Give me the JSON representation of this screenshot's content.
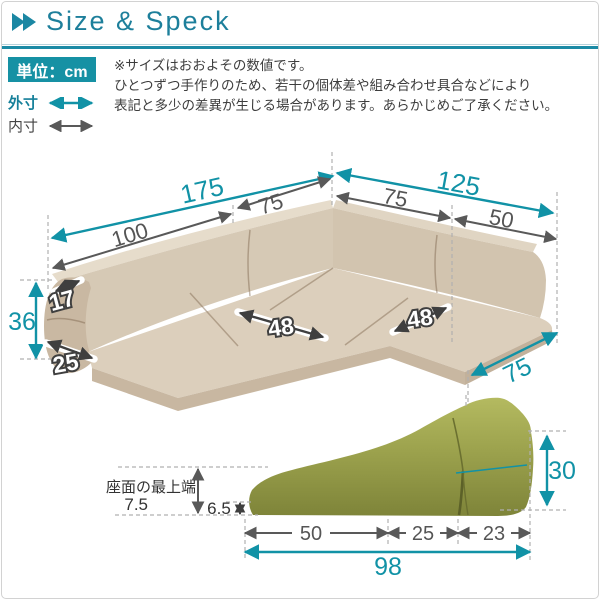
{
  "header": {
    "title": "Size & Speck"
  },
  "legend": {
    "unit": "単位：cm",
    "outer": "外寸",
    "inner": "内寸"
  },
  "notes": [
    "※サイズはおおよその数値です。",
    "ひとつずつ手作りのため、若干の個体差や組み合わせ具合などにより",
    "表記と多少の差異が生じる場合があります。あらかじめご了承ください。"
  ],
  "sofa": {
    "total_back_left": "175",
    "back_left": "100",
    "corner_left": "75",
    "total_back_right": "125",
    "corner_right": "75",
    "back_right": "50",
    "back_height": "36",
    "back_top_depth": "17",
    "back_bottom_depth": "25",
    "seat_width_left": "48",
    "seat_width_right": "48",
    "seat_depth": "75"
  },
  "cushion": {
    "seat_top_label": "座面の最上端",
    "seat_top_height": "7.5",
    "front_edge_height": "6.5",
    "seg_front": "50",
    "seg_mid": "25",
    "seg_back": "23",
    "total_length": "98",
    "back_height": "30"
  },
  "colors": {
    "teal": "#1192a6",
    "dim_gray": "#595959",
    "sofa_beige": "#d6c9b5",
    "cushion_green": "#9ca24d"
  }
}
